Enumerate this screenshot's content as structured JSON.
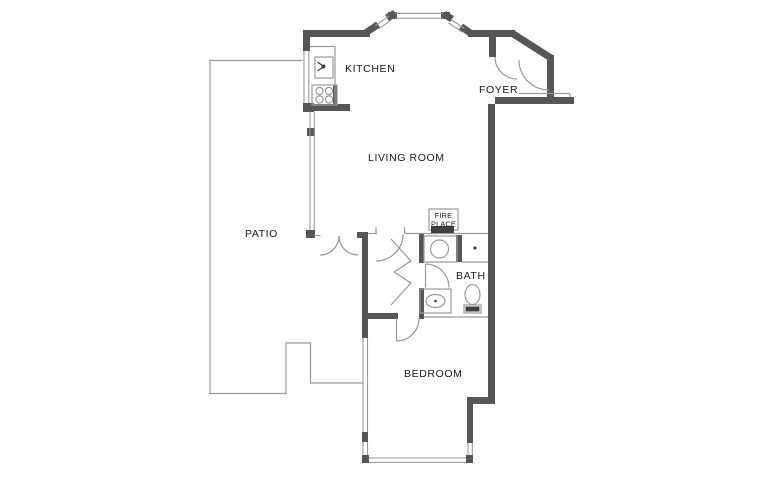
{
  "labels": {
    "kitchen": "KITCHEN",
    "foyer": "FOYER",
    "living_room": "LIVING ROOM",
    "patio": "PATIO",
    "bath": "BATH",
    "bedroom": "BEDROOM",
    "fireplace_line1": "FIRE",
    "fireplace_line2": "PLACE"
  },
  "colors": {
    "wall": "#565656",
    "thin_line": "#9a9a9a",
    "dark_fill": "#3f3f3f",
    "text": "#1a1a1a",
    "background": "#ffffff"
  },
  "icons": [
    "sink-icon",
    "cooktop-icon",
    "shower-icon",
    "closet-dot-icon",
    "toilet-icon",
    "vanity-sink-icon",
    "fireplace-band-icon",
    "bay-window",
    "door-arc"
  ]
}
